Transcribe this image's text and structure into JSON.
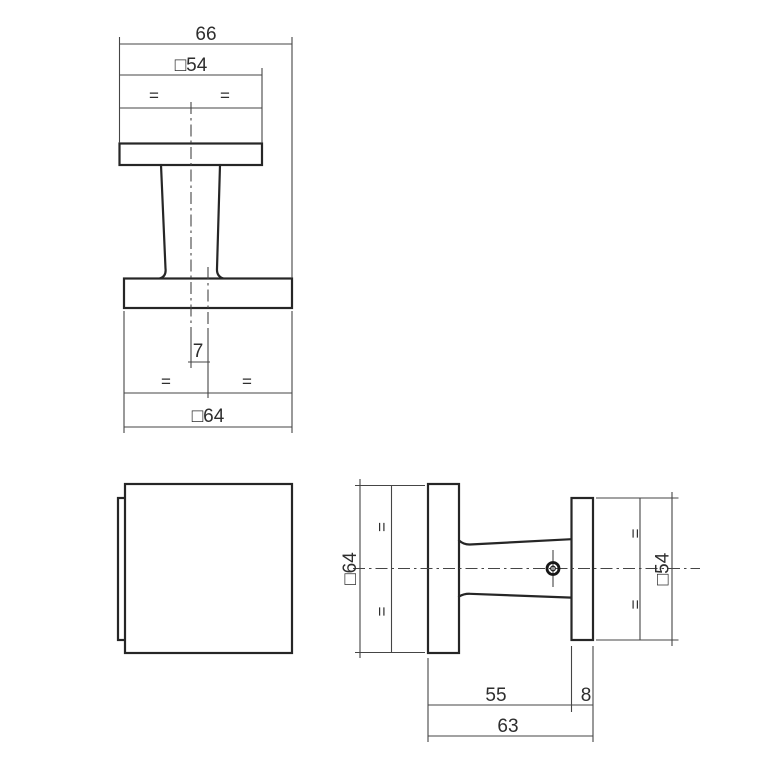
{
  "drawing": {
    "type": "technical-orthographic-drawing",
    "subject": "square door knob on square rose, three views with metric dimensions",
    "background_color": "#ffffff",
    "line_color": "#262626",
    "dimension_line_color": "#454545"
  },
  "views": {
    "side_elevation": {
      "dims": {
        "overall_width": "66",
        "face_square": "□54",
        "eq_top_left": "=",
        "eq_top_right": "=",
        "center_offset": "7",
        "eq_bottom_left": "=",
        "eq_bottom_right": "=",
        "base_square": "□64"
      }
    },
    "front_view": {},
    "profile_view": {
      "dims": {
        "base_square": "□64",
        "eq_left_top": "=",
        "eq_left_bottom": "=",
        "face_square": "□54",
        "eq_right_top": "=",
        "eq_right_bottom": "=",
        "neck_length": "55",
        "face_thickness": "8",
        "total_projection": "63"
      }
    }
  },
  "dimensions_mm": {
    "overall_width": 66,
    "face_plate_square": 54,
    "base_plate_square": 64,
    "center_offset": 7,
    "neck_length": 55,
    "face_plate_thickness": 8,
    "total_projection": 63
  }
}
